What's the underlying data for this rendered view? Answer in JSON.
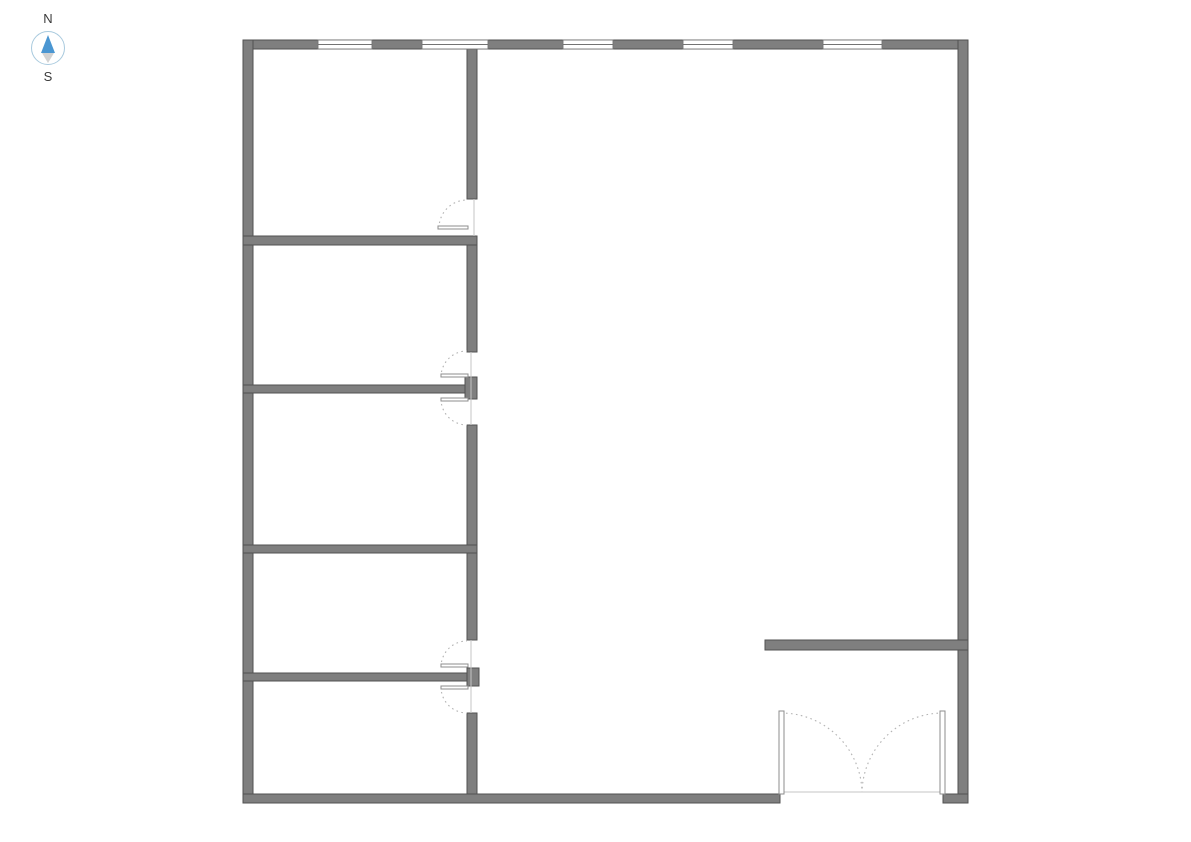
{
  "compass": {
    "north_label": "N",
    "south_label": "S"
  },
  "palette": {
    "background": "#ffffff",
    "wall_fill": "#7f7f7f",
    "wall_stroke": "#525252",
    "window_fill": "#ffffff",
    "window_stroke": "#737373",
    "door_panel_fill": "#ffffff",
    "door_panel_stroke": "#8c8c8c",
    "door_arc": "#b3b3b3",
    "thin_line": "#c6c6c6",
    "compass_circle": "#a9cade",
    "needle_north": "#4a96d2",
    "needle_south": "#d2d2d2"
  },
  "floorplan": {
    "canvas": {
      "width": 1191,
      "height": 842
    },
    "walls": [
      {
        "name": "wall-exterior-top",
        "x": 243,
        "y": 40,
        "w": 725,
        "h": 9
      },
      {
        "name": "wall-exterior-left",
        "x": 243,
        "y": 40,
        "w": 10,
        "h": 763
      },
      {
        "name": "wall-exterior-right",
        "x": 958,
        "y": 40,
        "w": 10,
        "h": 763
      },
      {
        "name": "wall-exterior-bottom-left",
        "x": 243,
        "y": 794,
        "w": 537,
        "h": 9
      },
      {
        "name": "wall-exterior-bottom-right",
        "x": 943,
        "y": 794,
        "w": 25,
        "h": 9
      },
      {
        "name": "wall-interior-vertical-seg-a",
        "x": 467,
        "y": 49,
        "w": 10,
        "h": 150
      },
      {
        "name": "wall-interior-vertical-seg-b",
        "x": 467,
        "y": 244,
        "w": 10,
        "h": 108
      },
      {
        "name": "wall-interior-vertical-seg-c",
        "x": 467,
        "y": 425,
        "w": 10,
        "h": 215
      },
      {
        "name": "wall-interior-vertical-seg-d",
        "x": 467,
        "y": 713,
        "w": 10,
        "h": 81
      },
      {
        "name": "wall-room-divider-1",
        "x": 243,
        "y": 236,
        "w": 234,
        "h": 9
      },
      {
        "name": "wall-room-divider-2",
        "x": 243,
        "y": 385,
        "w": 222,
        "h": 8
      },
      {
        "name": "wall-room-divider-2-end-cap",
        "x": 465,
        "y": 377,
        "w": 12,
        "h": 22
      },
      {
        "name": "wall-room-divider-3",
        "x": 243,
        "y": 545,
        "w": 234,
        "h": 8
      },
      {
        "name": "wall-room-divider-4",
        "x": 243,
        "y": 673,
        "w": 224,
        "h": 8
      },
      {
        "name": "wall-room-divider-4-end-cap",
        "x": 467,
        "y": 668,
        "w": 12,
        "h": 18
      },
      {
        "name": "wall-right-partition",
        "x": 765,
        "y": 640,
        "w": 203,
        "h": 10
      }
    ],
    "windows": [
      {
        "name": "window-1",
        "x": 318,
        "y": 40,
        "w": 54,
        "h": 9
      },
      {
        "name": "window-2",
        "x": 422,
        "y": 40,
        "w": 66,
        "h": 9
      },
      {
        "name": "window-3",
        "x": 563,
        "y": 40,
        "w": 50,
        "h": 9
      },
      {
        "name": "window-4",
        "x": 683,
        "y": 40,
        "w": 50,
        "h": 9
      },
      {
        "name": "window-5",
        "x": 823,
        "y": 40,
        "w": 59,
        "h": 9
      }
    ],
    "door_panels": [
      {
        "name": "door-1-panel",
        "x": 438,
        "y": 226,
        "w": 30,
        "h": 3
      },
      {
        "name": "door-2-upper-panel",
        "x": 441,
        "y": 374,
        "w": 27,
        "h": 3
      },
      {
        "name": "door-2-lower-panel",
        "x": 441,
        "y": 398,
        "w": 27,
        "h": 3
      },
      {
        "name": "door-3-upper-panel",
        "x": 441,
        "y": 664,
        "w": 27,
        "h": 3
      },
      {
        "name": "door-3-lower-panel",
        "x": 441,
        "y": 686,
        "w": 27,
        "h": 3
      },
      {
        "name": "entry-door-left-panel",
        "x": 779,
        "y": 711,
        "w": 5,
        "h": 83
      },
      {
        "name": "entry-door-right-panel",
        "x": 940,
        "y": 711,
        "w": 5,
        "h": 83
      }
    ],
    "door_arcs": [
      {
        "name": "door-1-swing-arc",
        "x1": 439,
        "y1": 228,
        "r": 28,
        "sweep": 1,
        "x2": 467,
        "y2": 200
      },
      {
        "name": "door-2-upper-swing-arc",
        "x1": 441,
        "y1": 377,
        "r": 26,
        "sweep": 1,
        "x2": 467,
        "y2": 351
      },
      {
        "name": "door-2-lower-swing-arc",
        "x1": 441,
        "y1": 399,
        "r": 26,
        "sweep": 0,
        "x2": 467,
        "y2": 425
      },
      {
        "name": "door-3-upper-swing-arc",
        "x1": 441,
        "y1": 667,
        "r": 26,
        "sweep": 1,
        "x2": 467,
        "y2": 641
      },
      {
        "name": "door-3-lower-swing-arc",
        "x1": 441,
        "y1": 687,
        "r": 26,
        "sweep": 0,
        "x2": 467,
        "y2": 713
      },
      {
        "name": "entry-door-left-swing-arc",
        "x1": 781,
        "y1": 713,
        "r": 81,
        "sweep": 1,
        "x2": 862,
        "y2": 792
      },
      {
        "name": "entry-door-right-swing-arc",
        "x1": 943,
        "y1": 713,
        "r": 81,
        "sweep": 0,
        "x2": 862,
        "y2": 792
      }
    ],
    "lines": [
      {
        "name": "entry-door-threshold-line",
        "x1": 781,
        "y1": 792,
        "x2": 942,
        "y2": 792
      },
      {
        "name": "door-1-jamb-line",
        "x1": 474,
        "y1": 199,
        "x2": 474,
        "y2": 236
      },
      {
        "name": "door-2-closed-line",
        "x1": 471,
        "y1": 352,
        "x2": 471,
        "y2": 425
      },
      {
        "name": "door-3-closed-line",
        "x1": 471,
        "y1": 640,
        "x2": 471,
        "y2": 713
      }
    ]
  }
}
